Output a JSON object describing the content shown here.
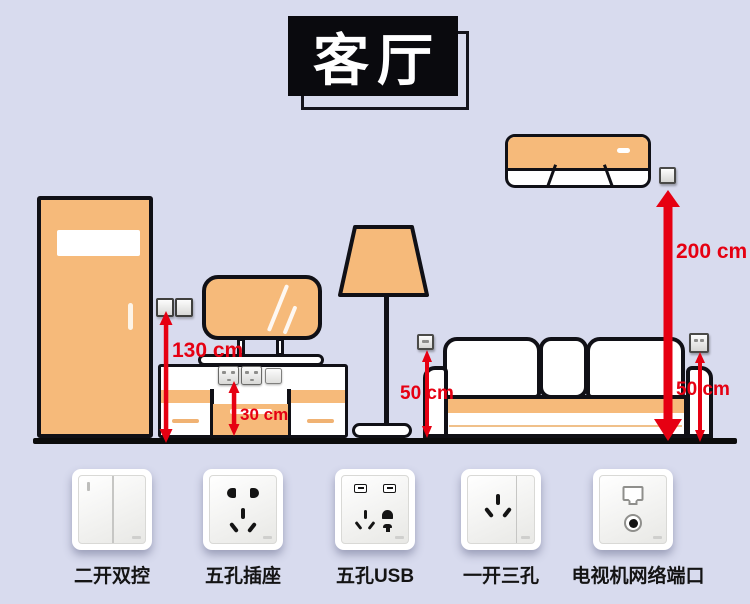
{
  "title": "客厅",
  "measurements": {
    "door_switch_height": "130 cm",
    "tv_cabinet_socket_height": "30 cm",
    "sofa_left_socket_height": "50 cm",
    "ac_socket_height": "200 cm",
    "sofa_right_socket_height": "50 cm"
  },
  "products": [
    {
      "label": "二开双控",
      "icon": "double-rocker-switch-icon"
    },
    {
      "label": "五孔插座",
      "icon": "five-hole-socket-icon"
    },
    {
      "label": "五孔USB",
      "icon": "five-hole-usb-socket-icon"
    },
    {
      "label": "一开三孔",
      "icon": "switch-with-three-hole-socket-icon"
    },
    {
      "label": "电视机网络端口",
      "icon": "tv-network-port-icon"
    }
  ],
  "scene_objects": [
    "door",
    "double-wall-switch",
    "tv-cabinet",
    "cabinet-sockets",
    "television",
    "floor-lamp",
    "sofa",
    "air-conditioner",
    "wall-sockets",
    "floor-line"
  ],
  "colors": {
    "background": "#d8dbee",
    "furniture_fill": "#f6ba7a",
    "outline": "#101016",
    "arrow_red": "#e60012",
    "title_bg": "#0a0a0e",
    "title_text": "#ffffff",
    "label_text": "#141414"
  }
}
